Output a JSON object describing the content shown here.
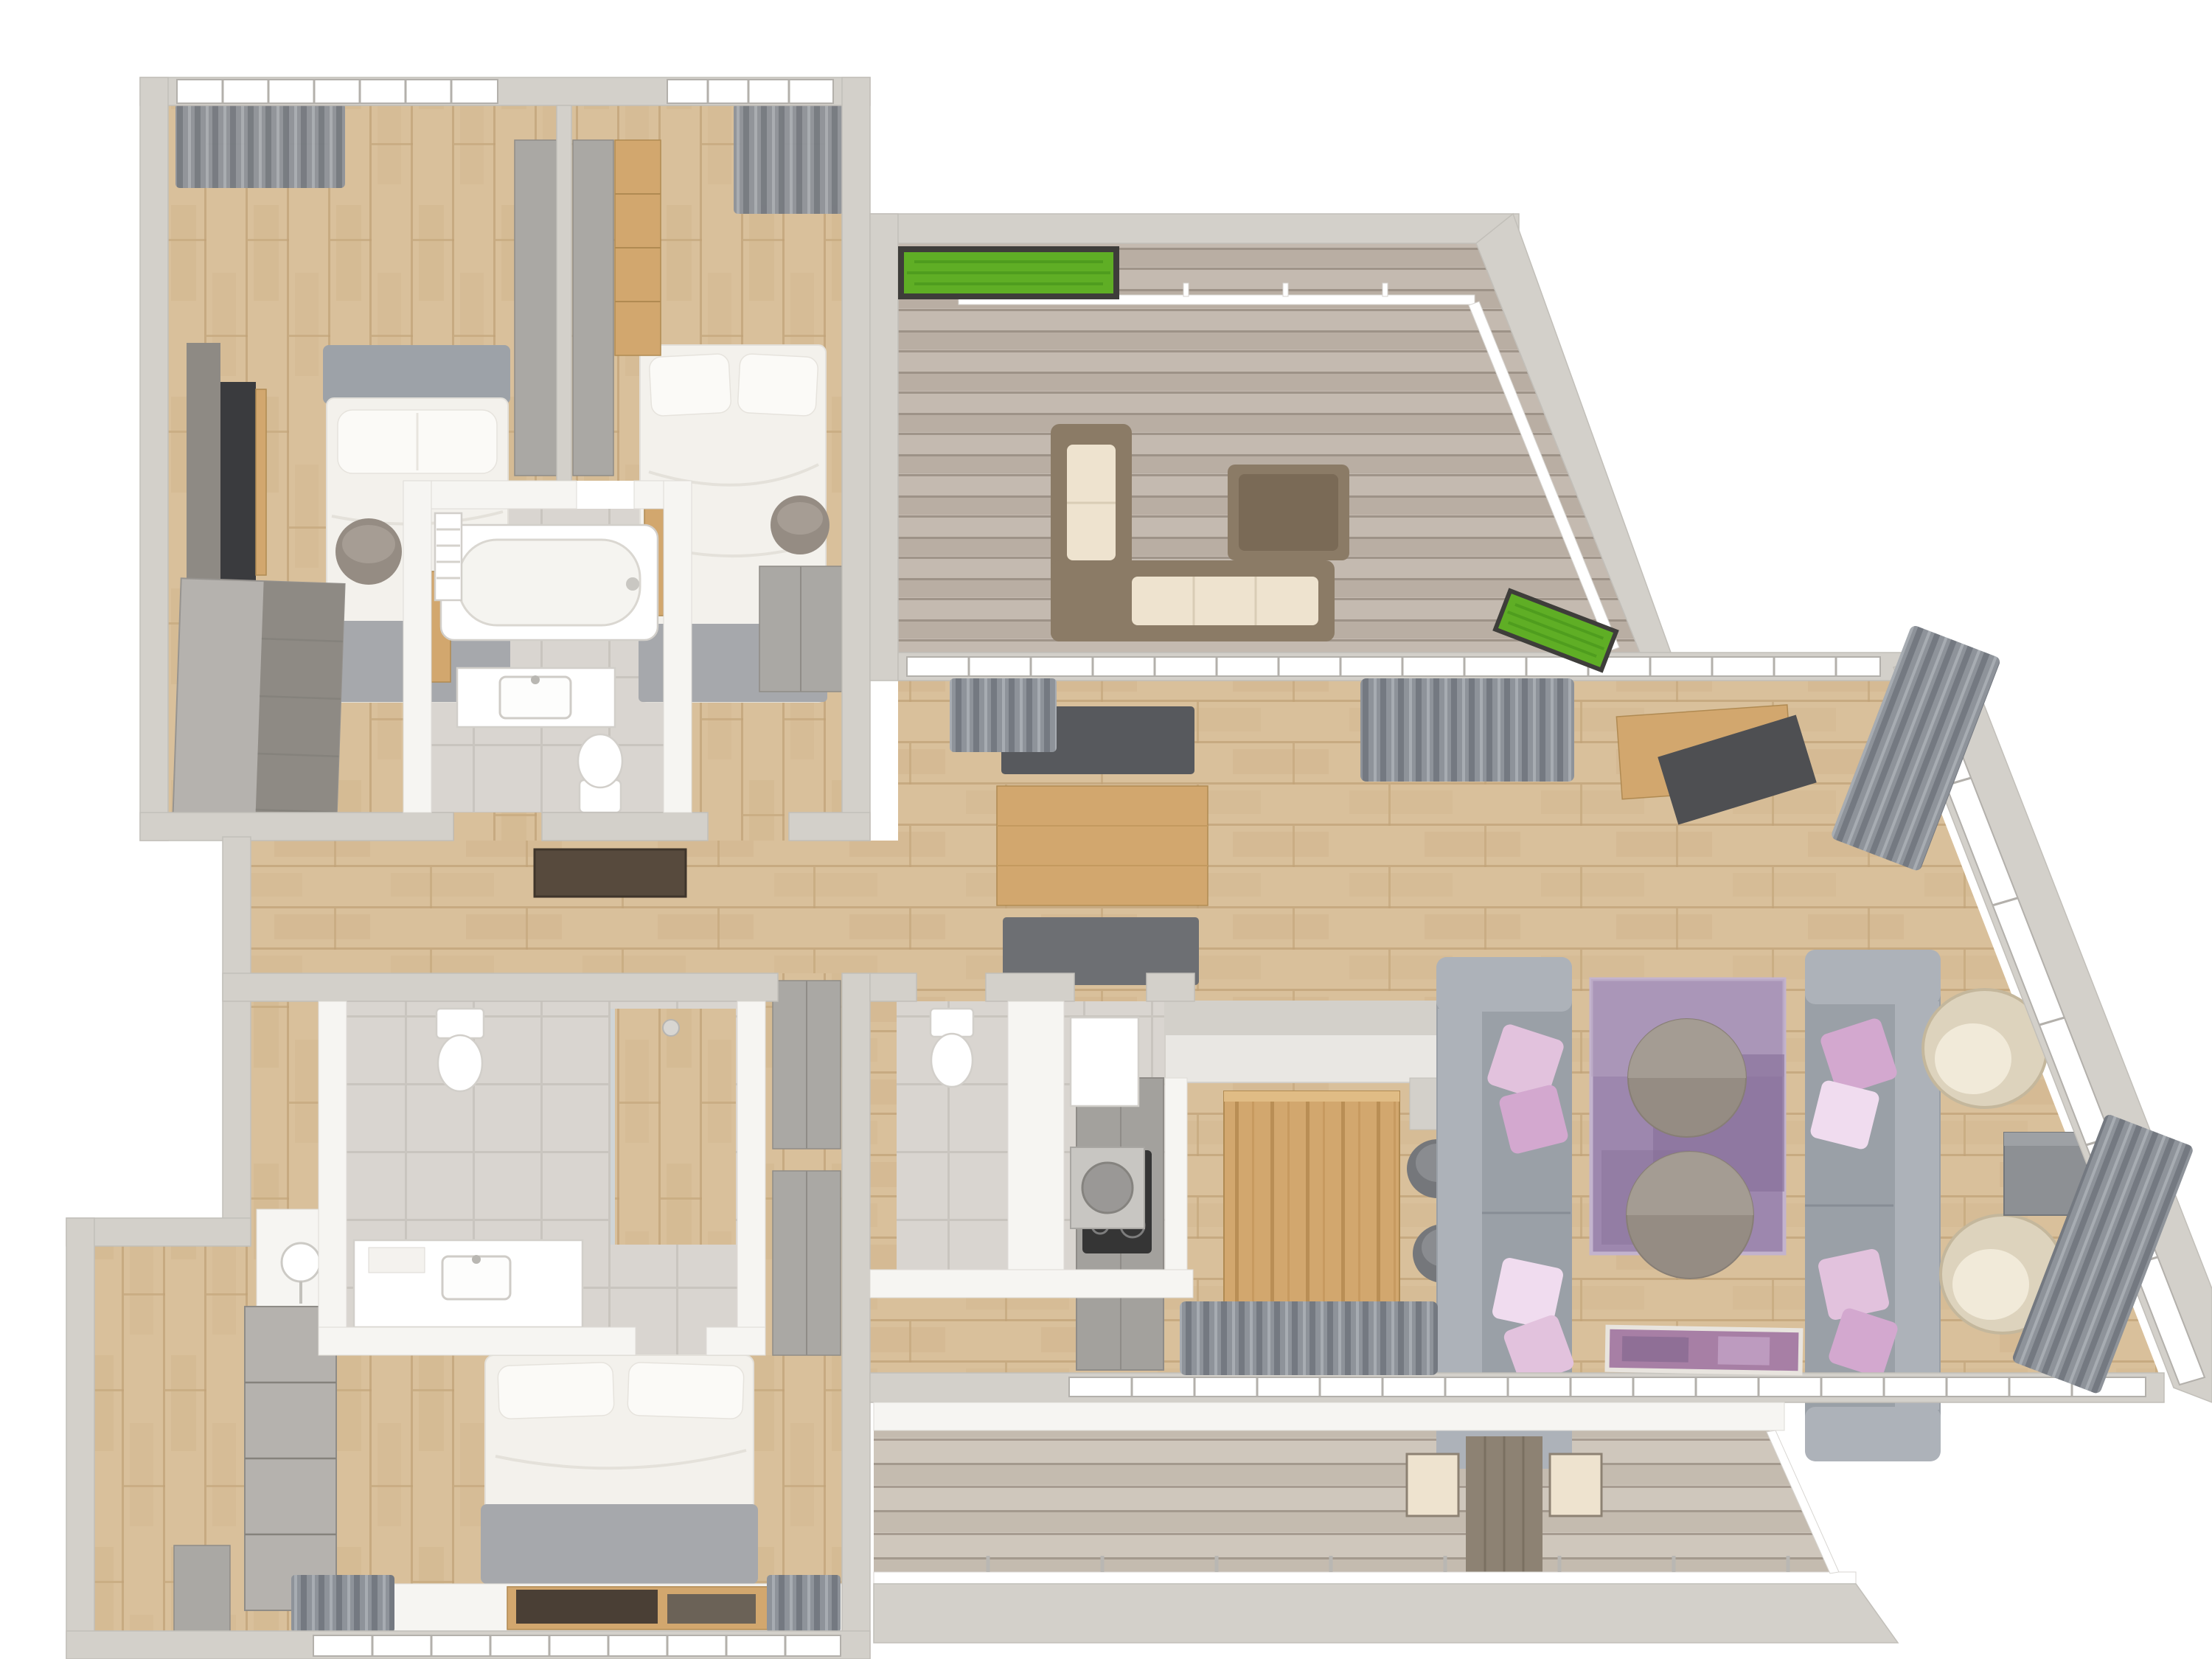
{
  "scene": {
    "kind": "3d-rendered-floor-plan-top-view",
    "background": "#ffffff",
    "text_visible": "none"
  },
  "colors": {
    "bg": "#ffffff",
    "wall": "#d3d0ca",
    "wallEdge": "#c2bfb9",
    "innerWall": "#f6f5f2",
    "winFrame": "#b3b0ab",
    "woodBase": "#d9c09b",
    "woodDark": "#c8ab80",
    "woodLine": "#bfa276",
    "tile": "#d9d5d0",
    "tileLine": "#c9c5bf",
    "deck": "#c4bab0",
    "deckDark": "#ac9f92",
    "deckLine": "#968b7f",
    "deckLight": "#cfc7bc",
    "sofa": "#9aa0a7",
    "sofaLight": "#adb2b9",
    "sofaDark": "#878d95",
    "pink": "#e2c2dd",
    "pink2": "#d3a8cf",
    "pinkLight": "#f0dcef",
    "rug": "#9d87ae",
    "rugLight": "#b5a2c1",
    "rugDark": "#856e97",
    "tableGray": "#958c83",
    "tableGrayLight": "#aaa198",
    "cream": "#ddd3bd",
    "creamDark": "#c4b79c",
    "wicker": "#8b7b66",
    "cushionCream": "#eee3cf",
    "darkFurn": "#57595d",
    "wood2": "#d2a76e",
    "grass": "#5fae25",
    "grassDark": "#4c9a1d",
    "planterBox": "#3e3d3a",
    "duvet": "#f3f1ec",
    "pillow": "#fbfaf7",
    "grayThrow": "#a6a8ac",
    "headboard": "#9da2a8",
    "wardrobe": "#aaa8a4",
    "wardrobeDark": "#8e8a84",
    "concrete": "#b5b2ae",
    "curtain": "#8e939a",
    "curtainDark": "#74798131",
    "matBrown": "#574a3d",
    "artPurple": "#a77fa5",
    "cooktop": "#353535"
  },
  "rooms": [
    {
      "id": "bedroom-1",
      "label_semantic": "upper-left bedroom",
      "floor": "wood"
    },
    {
      "id": "bedroom-2",
      "label_semantic": "upper-middle bedroom",
      "floor": "wood"
    },
    {
      "id": "family-bathroom",
      "label_semantic": "bathroom with bathtub",
      "floor": "tile"
    },
    {
      "id": "terrace",
      "label_semantic": "upper-right roof terrace",
      "floor": "decking"
    },
    {
      "id": "hallway",
      "label_semantic": "entry hallway",
      "floor": "wood"
    },
    {
      "id": "living-dining-kitchen",
      "label_semantic": "open plan living area",
      "floor": "wood"
    },
    {
      "id": "wc",
      "label_semantic": "guest wc",
      "floor": "tile"
    },
    {
      "id": "utility",
      "label_semantic": "utility / shower room",
      "floor": "tile"
    },
    {
      "id": "master-bedroom",
      "label_semantic": "lower-left bedroom",
      "floor": "wood"
    },
    {
      "id": "ensuite",
      "label_semantic": "en-suite bathroom",
      "floor": "tile"
    },
    {
      "id": "balcony",
      "label_semantic": "lower balcony",
      "floor": "decking"
    }
  ],
  "furniture": {
    "bedroom-1": [
      "double-bed",
      "wall-tv",
      "dresser",
      "pouf",
      "curtains",
      "window"
    ],
    "bedroom-2": [
      "double-bed",
      "wardrobe",
      "pouf",
      "curtains",
      "window"
    ],
    "family-bathroom": [
      "bathtub",
      "towel-radiator",
      "vanity-sink",
      "toilet"
    ],
    "terrace": [
      "wicker-corner-sofa",
      "wicker-coffee-table",
      "grass-planter-top",
      "grass-planter-bottom",
      "glass-railing"
    ],
    "living-dining-kitchen": [
      "dining-table",
      "dining-bench-top",
      "dining-bench-bottom",
      "kitchen-tall-units",
      "cooktop",
      "kitchen-island",
      "bar-stools",
      "sofa-left",
      "sofa-right",
      "purple-rug",
      "round-coffee-tables",
      "rattan-armchairs",
      "side-table",
      "tv-sideboard",
      "leaning-tv",
      "curtains",
      "artwork"
    ],
    "wc": [
      "toilet"
    ],
    "utility": [
      "boiler-cabinet",
      "washing-machine"
    ],
    "master-bedroom": [
      "double-bed",
      "wall-panel",
      "wardrobes",
      "window-bench",
      "books",
      "side-cabinet",
      "curtains"
    ],
    "ensuite": [
      "toilet",
      "vanity-sink",
      "table-lamp",
      "shower"
    ],
    "balcony": [
      "outdoor-table",
      "outdoor-chairs",
      "glass-railing"
    ],
    "hallway": [
      "doormat"
    ]
  }
}
